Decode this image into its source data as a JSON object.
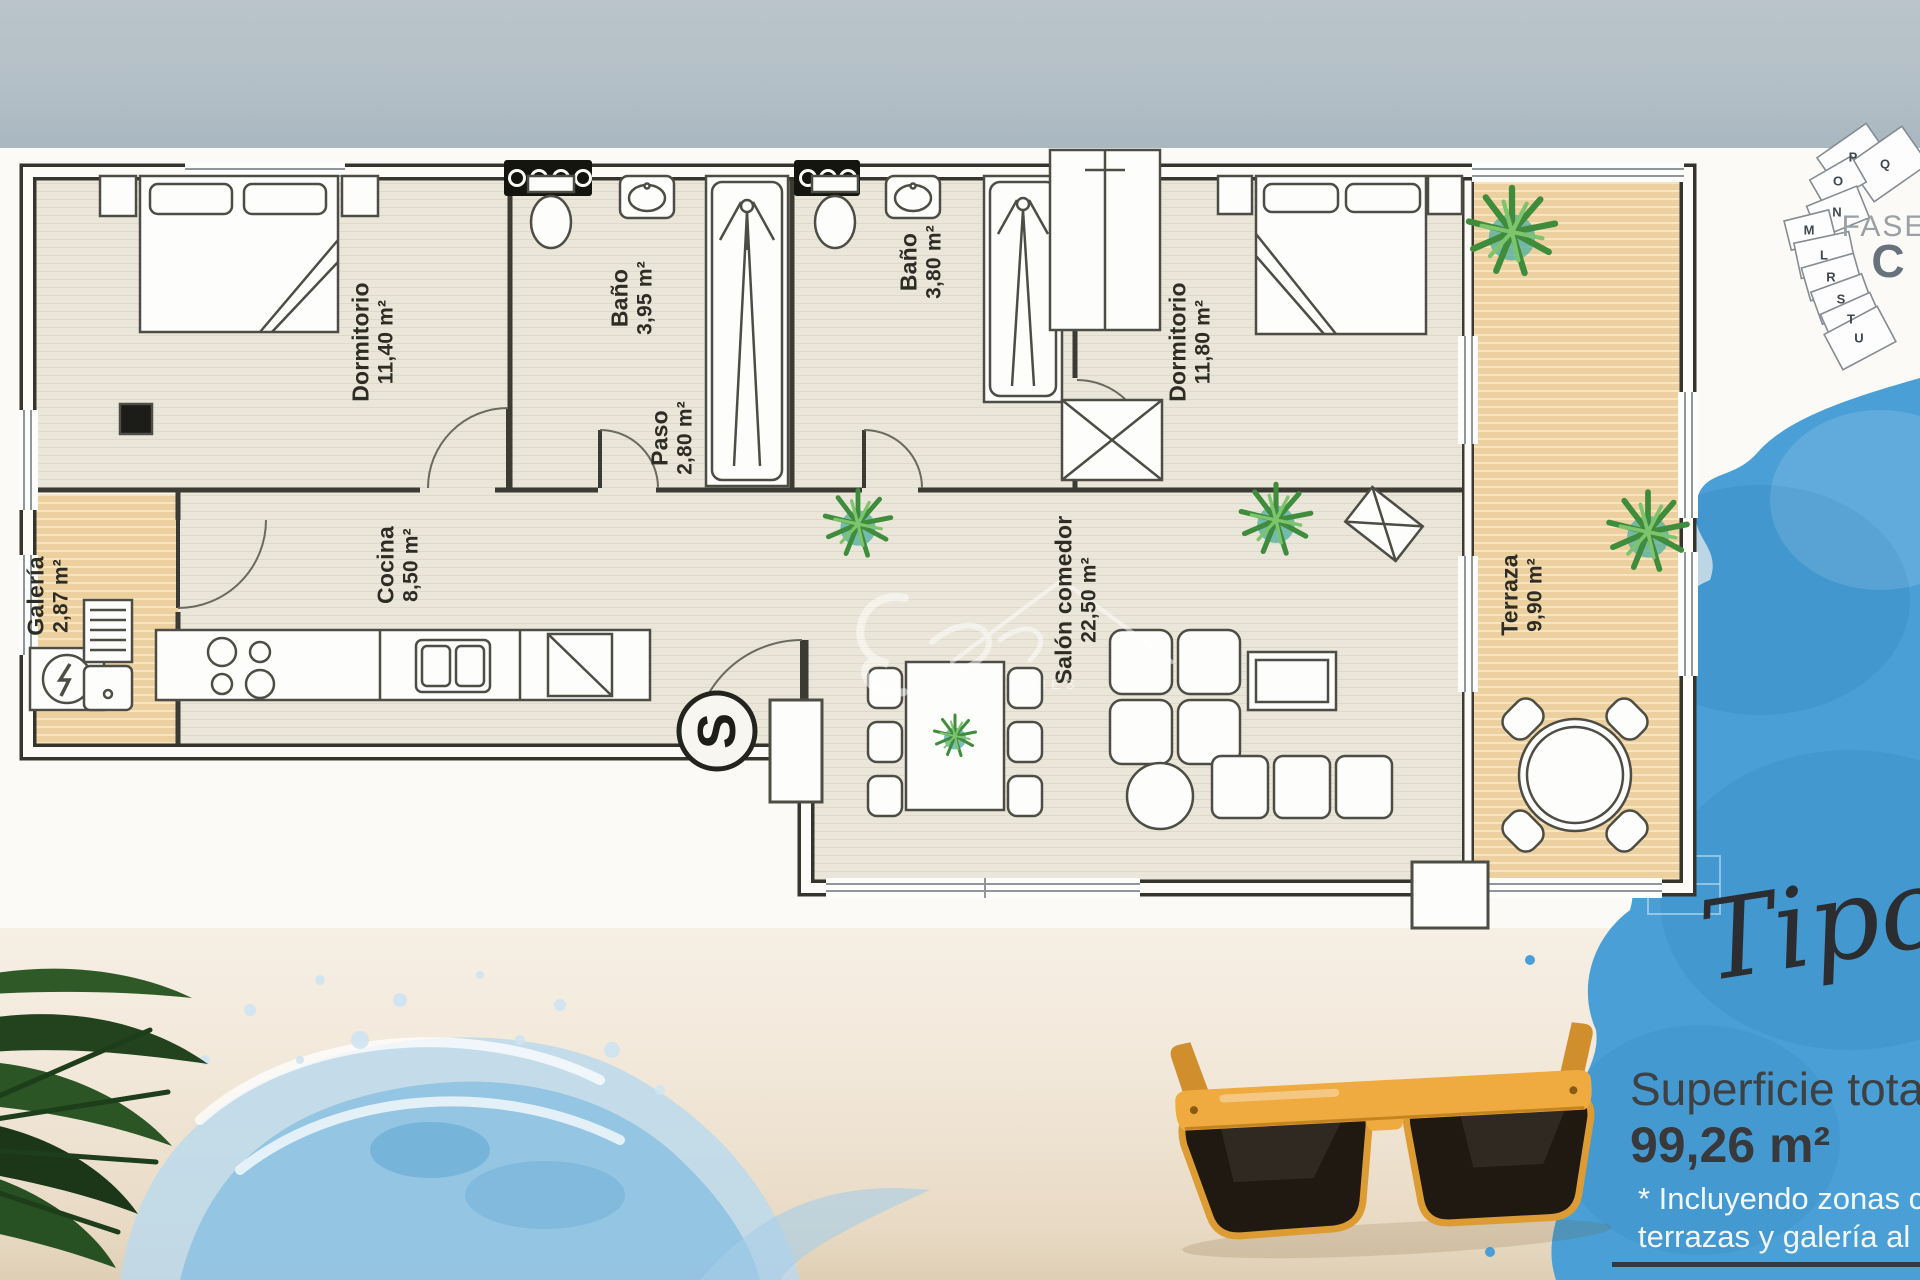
{
  "colors": {
    "accent_blue": "#4aa0d6",
    "wood": "#ecd0a0",
    "floor": "#eae6d9",
    "wall": "#35352e",
    "sunglasses_frame": "#efab40"
  },
  "site_plan": {
    "fase_label": "FASE",
    "fase_letter": "C",
    "blocks": [
      "P",
      "Q",
      "O",
      "N",
      "M",
      "L",
      "R",
      "S",
      "T",
      "U"
    ]
  },
  "floor_plan": {
    "compass_letter": "S",
    "watermark_fragment": "RTIES",
    "rooms": [
      {
        "id": "dormitorio-1",
        "name": "Dormitorio",
        "area": "11,40 m²"
      },
      {
        "id": "bano-1",
        "name": "Baño",
        "area": "3,95 m²"
      },
      {
        "id": "bano-2",
        "name": "Baño",
        "area": "3,80 m²"
      },
      {
        "id": "dormitorio-2",
        "name": "Dormitorio",
        "area": "11,80 m²"
      },
      {
        "id": "paso",
        "name": "Paso",
        "area": "2,80 m²"
      },
      {
        "id": "cocina",
        "name": "Cocina",
        "area": "8,50 m²"
      },
      {
        "id": "galeria",
        "name": "Galería",
        "area": "2,87 m²"
      },
      {
        "id": "salon-comedor",
        "name": "Salón comedor",
        "area": "22,50 m²"
      },
      {
        "id": "terraza",
        "name": "Terraza",
        "area": "9,90 m²"
      }
    ]
  },
  "script_title": "Tipo",
  "summary": {
    "title": "Superficie tota",
    "area_value": "99,26 m²",
    "note_line1": "* Incluyendo zonas co",
    "note_line2": "terrazas y galería al 10"
  }
}
